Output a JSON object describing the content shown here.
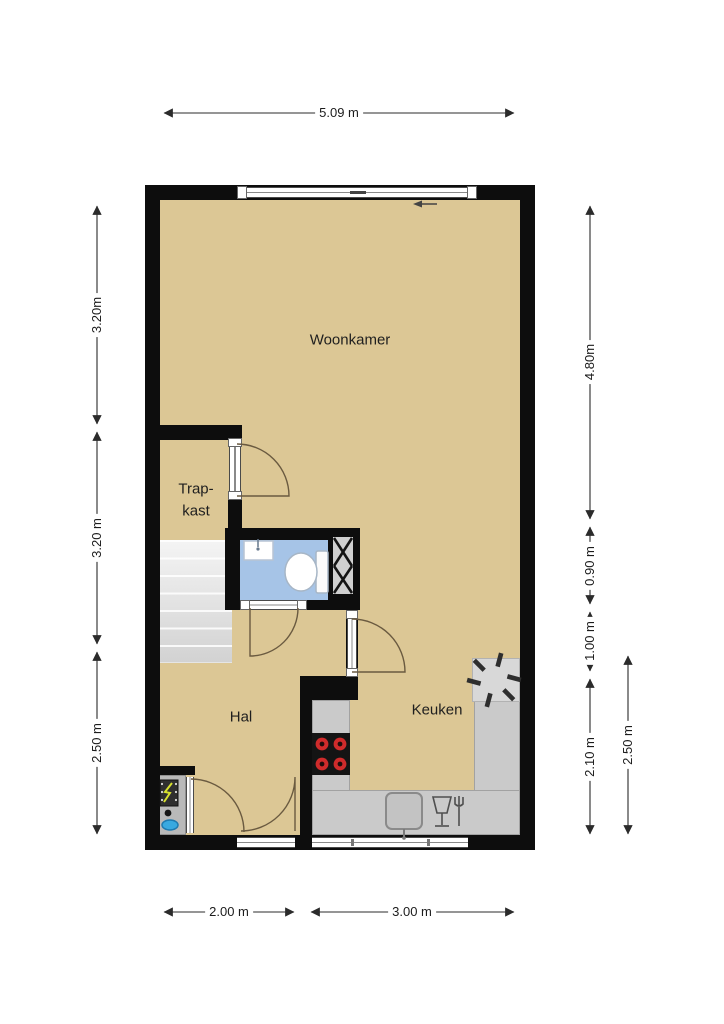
{
  "plan": {
    "rooms": {
      "woonkamer": "Woonkamer",
      "trapkast_line1": "Trap-",
      "trapkast_line2": "kast",
      "hal": "Hal",
      "keuken": "Keuken"
    },
    "dimensions": {
      "top": "5.09 m",
      "left": [
        "3.20m",
        "3.20 m",
        "2.50 m"
      ],
      "right_inner": [
        "4.80m",
        "0.90 m",
        "1.00 m",
        "2.10 m"
      ],
      "right_outer": "2.50 m",
      "bottom": [
        "2.00 m",
        "3.00 m"
      ]
    },
    "fixtures": {
      "icons": [
        "sliding-window-arrow-icon",
        "stairs",
        "toilet",
        "washbasin",
        "duct-shaft-hatch",
        "boiler-fan-icon",
        "cooktop-burners",
        "kitchen-sink",
        "dishwasher-icon",
        "meter-cupboard-symbols"
      ]
    },
    "colors": {
      "floor": "#dcc795",
      "wall": "#0d0d0d",
      "bathroom_floor": "#a6c4e7",
      "counter": "#cacaca",
      "stairs_light": "#f4f4f4",
      "burner_red": "#cf2b2b",
      "water_blue": "#39a9e0",
      "bolt_yellow": "#d6df2e",
      "dimension_text": "#1c1c1c"
    }
  }
}
